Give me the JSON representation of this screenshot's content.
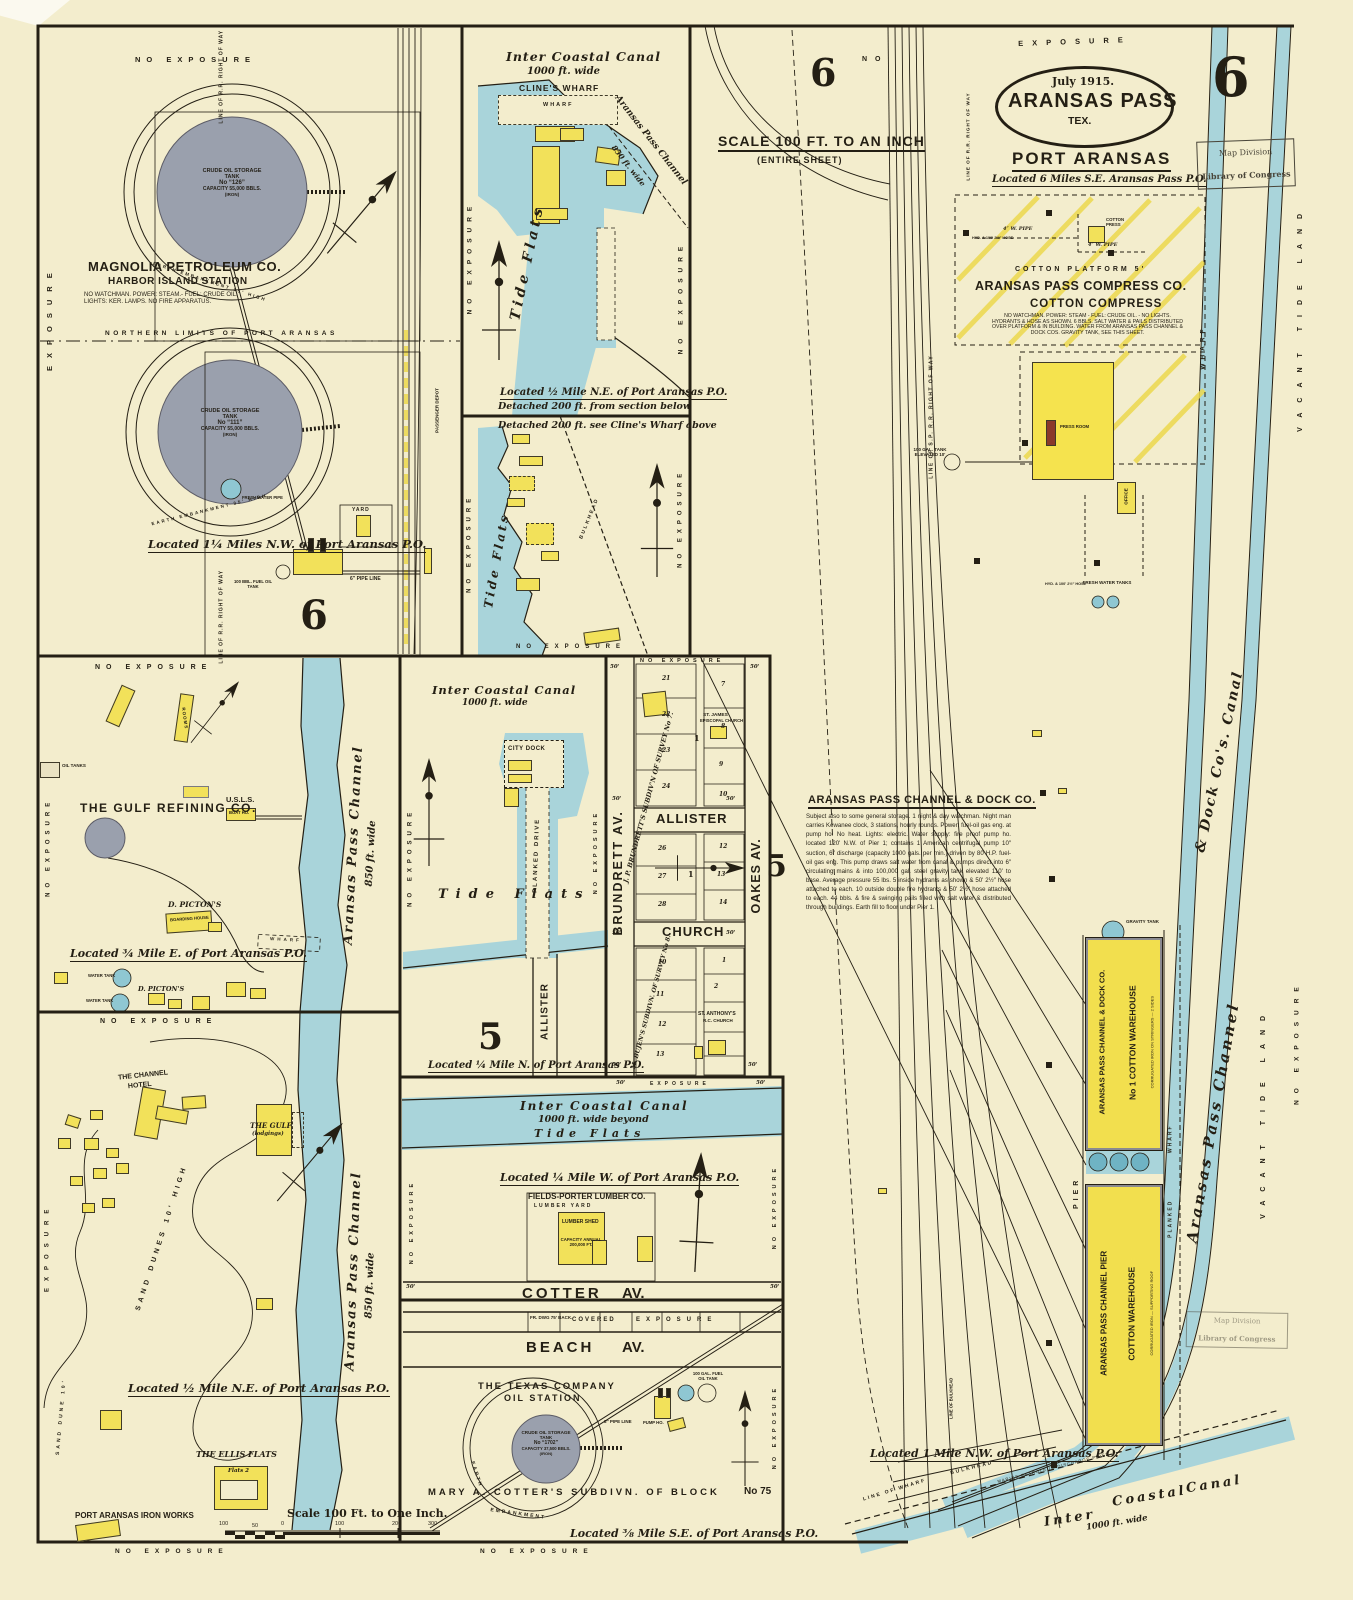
{
  "sheet": {
    "page_number": "6",
    "stamp_line1": "Map Division",
    "stamp_line2": "Library of Congress"
  },
  "title": {
    "date": "July 1915.",
    "city": "ARANSAS PASS",
    "state": "TEX.",
    "place": "PORT ARANSAS",
    "located": "Located 6 Miles S.E. Aransas Pass P.O."
  },
  "common": {
    "no_exposure": "NO EXPOSURE",
    "exposure": "EXPOSURE",
    "no": "NO",
    "dim": "50'",
    "wharf": "WHARF",
    "bulkhead": "BULKHEAD",
    "hyd": "HYD. & 100' 2½″ HOSE"
  },
  "scalebar": {
    "label": "Scale 100 Ft. to One Inch.",
    "t1": "100",
    "t2": "50",
    "t3": "0",
    "t4": "100",
    "t5": "200",
    "t6": "300"
  },
  "magnolia": {
    "company": "MAGNOLIA PETROLEUM CO.",
    "station": "HARBOR ISLAND STATION",
    "notes": "NO WATCHMAN. POWER: STEAM.- FUEL: CRUDE OIL.\nLIGHTS: KER. LAMPS. NO FIRE APPARATUS.",
    "tank1": {
      "l1": "CRUDE OIL STORAGE",
      "l2": "TANK",
      "l3": "No “126”",
      "l4": "CAPACITY 55,000 BBLS.",
      "l5": "(IRON)"
    },
    "tank2": {
      "l1": "CRUDE OIL STORAGE",
      "l2": "TANK",
      "l3": "No “111”",
      "l4": "CAPACITY 55,000 BBLS.",
      "l5": "(IRON)"
    },
    "embankment": "EARTH EMBANKMENT 35' HIGH",
    "boundary": "NORTHERN LIMITS OF PORT ARANSAS",
    "located": "Located 1¼ Miles N.W. of Port Aransas P.O.",
    "yard": "YARD",
    "pipe6": "6″ PIPE LINE",
    "fuel": "100 BBL. FUEL OIL TANK",
    "fresh": "FRESH WATER PIPE",
    "rr": "LINE OF R.R. RIGHT OF WAY",
    "depot": "PASSENGER DEPOT",
    "section": "6"
  },
  "clines": {
    "canal1": "Inter Coastal Canal",
    "canal2": "1000 ft. wide",
    "name": "CLINE'S WHARF",
    "wharf": "WHARF",
    "channel": "Aransas Pass Channel",
    "channel_w": "850 ft. wide",
    "tide": "Tide Flats",
    "located": "Located ½ Mile N.E. of Port Aransas P.O.",
    "detached": "Detached 200 ft. from section below"
  },
  "shore": {
    "detached": "Detached 200 ft. see Cline's Wharf above",
    "tide": "Tide Flats"
  },
  "gulf": {
    "company": "THE GULF REFINING CO.",
    "usls": "U.S.L.S.",
    "boat": "BOAT HO.",
    "picton1": "D. PICTON'S",
    "boarding": "BOARDING HOUSE",
    "picton2": "D. PICTON'S",
    "located": "Located ¾ Mile E. of Port Aransas P.O.",
    "channel": "Aransas Pass Channel",
    "channel_w": "850 ft. wide",
    "oil": "OIL TANKS",
    "water": "WATER TANK",
    "rooms": "ROOMS"
  },
  "dunes": {
    "hotel1": "THE CHANNEL",
    "hotel2": "HOTEL",
    "gulf1": "THE GULF",
    "gulf2": "(lodgings)",
    "dunes": "SAND DUNES 10' HIGH",
    "dune": "SAND DUNE 10'",
    "located": "Located ½ Mile N.E. of Port Aransas P.O.",
    "ellis": "THE ELLIS FLATS",
    "flats": "Flats 2",
    "iron": "PORT ARANSAS IRON WORKS",
    "channel": "Aransas Pass Channel",
    "channel_w": "850 ft. wide"
  },
  "citydock": {
    "canal1": "Inter Coastal Canal",
    "canal2": "1000 ft. wide",
    "dock": "CITY DOCK",
    "drive": "PLANKED DRIVE",
    "tide": "Tide Flats",
    "allister": "ALLISTER",
    "section": "5",
    "located": "Located ¼ Mile N. of Port Aransas P.O."
  },
  "grid": {
    "brundrett": "BRUNDRETT AV.",
    "oakes": "OAKES AV.",
    "allister": "ALLISTER",
    "church": "CHURCH",
    "survey7": "J. P. BRUNDRETT'S SUBDIV'N OF SURVEY No 7.",
    "survey8": "M. BUJEN'S SUBDIVN. OF SURVEY No 8.",
    "james1": "ST. JAMES",
    "james2": "EPISCOPAL CHURCH",
    "anthony1": "ST. ANTHONY'S",
    "anthony2": "R.C. CHURCH",
    "b1": "1",
    "b2": "1",
    "lots": [
      "21",
      "22",
      "23",
      "24",
      "7",
      "8",
      "9",
      "10",
      "26",
      "27",
      "28",
      "12",
      "13",
      "14",
      "1",
      "2",
      "10",
      "11",
      "12",
      "13"
    ]
  },
  "lumber": {
    "canal1": "Inter Coastal Canal",
    "canal2": "1000 ft. wide beyond",
    "tide": "Tide Flats",
    "located": "Located ¼ Mile W. of Port Aransas P.O.",
    "company": "FIELDS-PORTER LUMBER CO.",
    "yard": "LUMBER YARD",
    "shed": "LUMBER SHED",
    "cap": "CAPACITY ANNUAL\n200,000 FT.",
    "cotter": "COTTER",
    "av": "AV."
  },
  "texas": {
    "fr": "FR. DWG 75' BACK.",
    "covered": "COVERED",
    "beach": "BEACH",
    "av": "AV.",
    "co1": "THE TEXAS COMPANY",
    "co2": "OIL STATION",
    "tank": {
      "l1": "CRUDE OIL STORAGE",
      "l2": "TANK",
      "l3": "No “1702”",
      "l4": "CAPACITY 37,500 BBLS.",
      "l5": "(IRON)"
    },
    "earth": "EARTH",
    "embank": "EMBANKMENT",
    "pipe": "8″ PIPE LINE",
    "pump": "PUMP HO.",
    "fuel": "100 GAL. FUEL OIL TANK",
    "subdiv": "MARY A. COTTER'S SUBDIVN. OF BLOCK",
    "blockno": "No 75",
    "located": "Located ⅜ Mile S.E. of Port Aransas P.O."
  },
  "port": {
    "scale": "SCALE 100 FT. TO AN INCH",
    "scale2": "(ENTIRE SHEET)",
    "six": "6",
    "five": "5",
    "platform": "COTTON PLATFORM 5'",
    "compress_co": "ARANSAS PASS COMPRESS CO.",
    "compress": "COTTON COMPRESS",
    "compress_notes": "NO WATCHMAN. POWER: STEAM - FUEL: CRUDE OIL. - NO LIGHTS.\nHYDRANTS & HOSE AS SHOWN. 6 BBLS. SALT WATER & PAILS DISTRIBUTED\nOVER PLATFORM & IN BUILDING. WATER FROM ARANSAS PASS CHANNEL &\nDOCK COS. GRAVITY TANK, SEE THIS SHEET.",
    "wpipe": "4″ W. PIPE",
    "press": "COTTON PRESS",
    "pressroom": "PRESS ROOM",
    "office": "OFFICE",
    "fresh": "FRESH WATER TANKS",
    "elev": "100 GAL. TANK\nELEVATED 10'",
    "gravity": "GRAVITY TANK",
    "dockco_head": "ARANSAS PASS CHANNEL & DOCK CO.",
    "dockco_body": "Subject also to some general storage. 1 night & day watchman. Night man carries Kewanee clock, 3 stations, hourly rounds. Power: fuel-oil gas eng. at pump ho. No heat. Lights: electric. Water supply: fire proof pump ho. located 120' N.W. of Pier 1; contains 1 American centrifugal pump 10″ suction, 6″ discharge (capacity 1000 gals. per min.) driven by 80 H.P. fuel-oil gas eng. This pump draws salt water from canal & pumps direct into 6″ circulating mains & into 100,000 gal. steel gravity tank elevated 110' to base. Average pressure 55 lbs. 5 inside hydrants as shown & 50' 2½″ hose attached to each. 10 outside double fire hydrants & 50' 2½″ hose attached to each. 44 bbls. & fire & swinging pails filled with salt water & distributed through buildings. Earth fill to floor under Pier 1.",
    "w1a": "ARANSAS PASS CHANNEL & DOCK CO.",
    "w1b": "No 1 COTTON WAREHOUSE",
    "w1n": "CORRUGATED IRON ON STRINGERS — 2 SIDES",
    "w2a": "ARANSAS PASS CHANNEL PIER",
    "w2b": "COTTON WAREHOUSE",
    "w2n": "CORRUGATED IRON — SUPPORTING ROOF",
    "pier": "PIER",
    "planked": "PLANKED",
    "located": "Located 1 Mile N.W. of Port Aransas P.O.",
    "canal1": "Aransas Pass Channel",
    "canal2": "& Dock Co's. Canal",
    "vacant": "VACANT TIDE LAND",
    "line_wharf": "LINE OF WHARF",
    "line_bulk": "LINE OF BULKHEAD",
    "marine": "MARINE PETROLEUM DISCHARGE PIPES",
    "icc1": "Inter",
    "icc2": "Coastal",
    "icc3": "Canal",
    "icc4": "1000 ft. wide",
    "rr": "LINE OF S.P. R.R. RIGHT OF WAY",
    "rr2": "LINE OF R.R. RIGHT OF WAY"
  }
}
